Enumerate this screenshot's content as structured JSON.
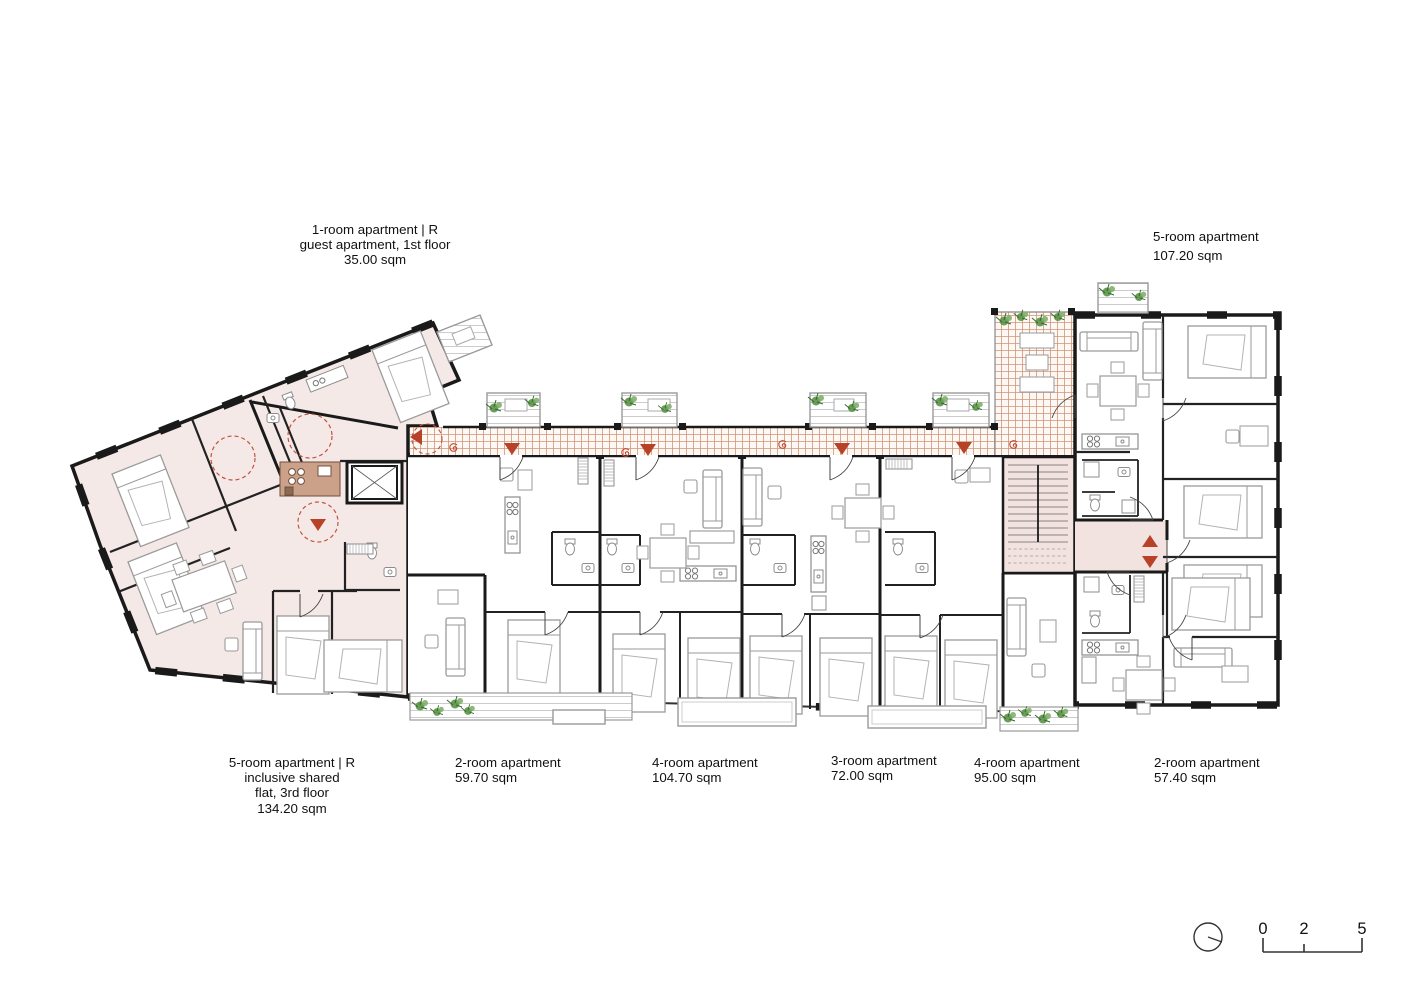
{
  "apartments": [
    {
      "id": "guest-1room",
      "lines": [
        "1-room apartment | R",
        "guest apartment, 1st floor",
        "35.00 sqm"
      ]
    },
    {
      "id": "five-room-ne",
      "lines": [
        "5-room apartment",
        "107.20 sqm"
      ]
    },
    {
      "id": "inclusive-5room",
      "lines": [
        "5-room apartment | R",
        "inclusive shared",
        "flat, 3rd floor",
        "134.20 sqm"
      ]
    },
    {
      "id": "two-room-a",
      "lines": [
        "2-room apartment",
        "59.70 sqm"
      ]
    },
    {
      "id": "four-room-a",
      "lines": [
        "4-room apartment",
        "104.70 sqm"
      ]
    },
    {
      "id": "three-room-a",
      "lines": [
        "3-room apartment",
        "72.00 sqm"
      ]
    },
    {
      "id": "four-room-b",
      "lines": [
        "4-room apartment",
        "95.00 sqm"
      ]
    },
    {
      "id": "two-room-b",
      "lines": [
        "2-room apartment",
        "57.40 sqm"
      ]
    }
  ],
  "scale_bar": {
    "ticks": [
      "0",
      "2",
      "5"
    ]
  },
  "colors": {
    "wall": "#1a1a1a",
    "apartment_highlight": "#f4e9e7",
    "stair_hall": "#f2e3e0",
    "walkway_hatch_line": "#cf9578",
    "walkway_bg": "#fdf8f3",
    "entrance_red": "#b84228",
    "plant_green": "#5b9247",
    "furniture_gray": "#9a9a9a",
    "kitchen_brown": "#cba189",
    "balcony_gray": "#999999"
  }
}
